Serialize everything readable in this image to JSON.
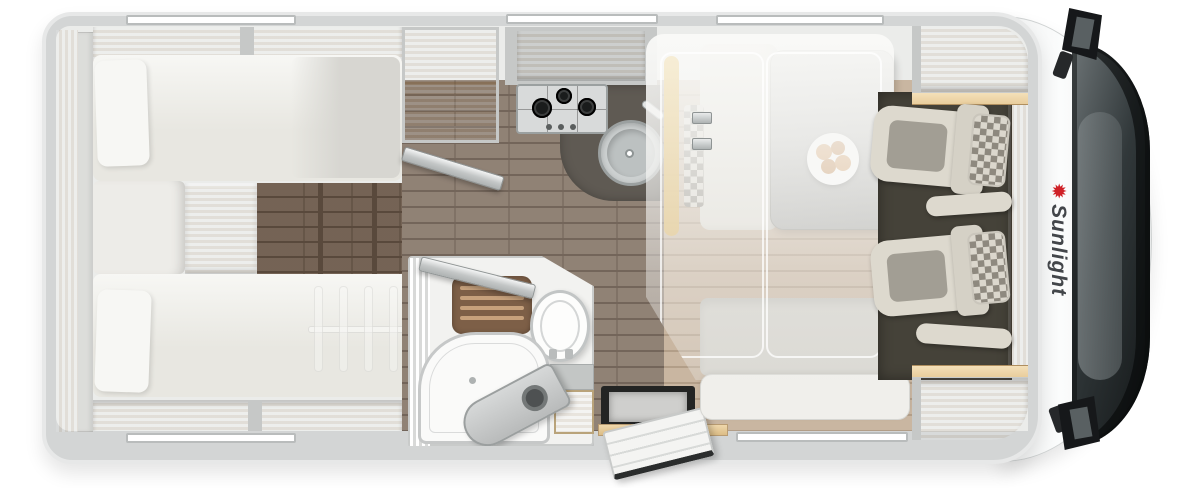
{
  "brand": {
    "logo_text": "Sunlight",
    "logo_icon": "sun-icon"
  },
  "colors": {
    "wall": "#d3d5d5",
    "wallEdge": "#e7e8e8",
    "interior": "#ebecea",
    "wood": "#e8c594",
    "woodHi": "#f3dab0",
    "woodLo": "#d6ae77",
    "grayDivider": "#c6c8c7",
    "mattress": "#e8e7e1",
    "pillow": "#f7f7f4",
    "blanket": "#d7d6d1",
    "floorDark": "#6f5d4e",
    "floorDarkLine": "#59493c",
    "floorKitchen": "#8a7b6e",
    "floorKitchenLine": "#73655a",
    "floorDinette": "#c9b6a1",
    "floorDinetteLine": "#b29e88",
    "counterDark": "#5f5a53",
    "steel": "#d8dada",
    "steelEdge": "#9ba0a0",
    "burner": "#1a1c1c",
    "bathWall": "#f2f2f0",
    "duckboard": "#7d5f47",
    "duckSlat": "#c6a17c",
    "cabFloor": "#454239",
    "seatCream": "#ddd9ce",
    "seatGray": "#a29e94",
    "checkerA": "#8e897f",
    "checkerB": "#dbd7cd",
    "table": "#b3b3b0",
    "plate": "#ffffff",
    "food1": "#d49a5e",
    "food2": "#c2854a",
    "cabBodyEdge": "#cfd2d2",
    "shieldLight": "#6d7476",
    "shieldMid": "#31383a",
    "shieldDark": "#121516",
    "mirror": "#16181a",
    "stepWell": "#232423",
    "windowSlot": "#ffffff",
    "windowBorder": "#b9bcbc",
    "logoText": "#43464a",
    "logoRed": "#cf2127"
  }
}
